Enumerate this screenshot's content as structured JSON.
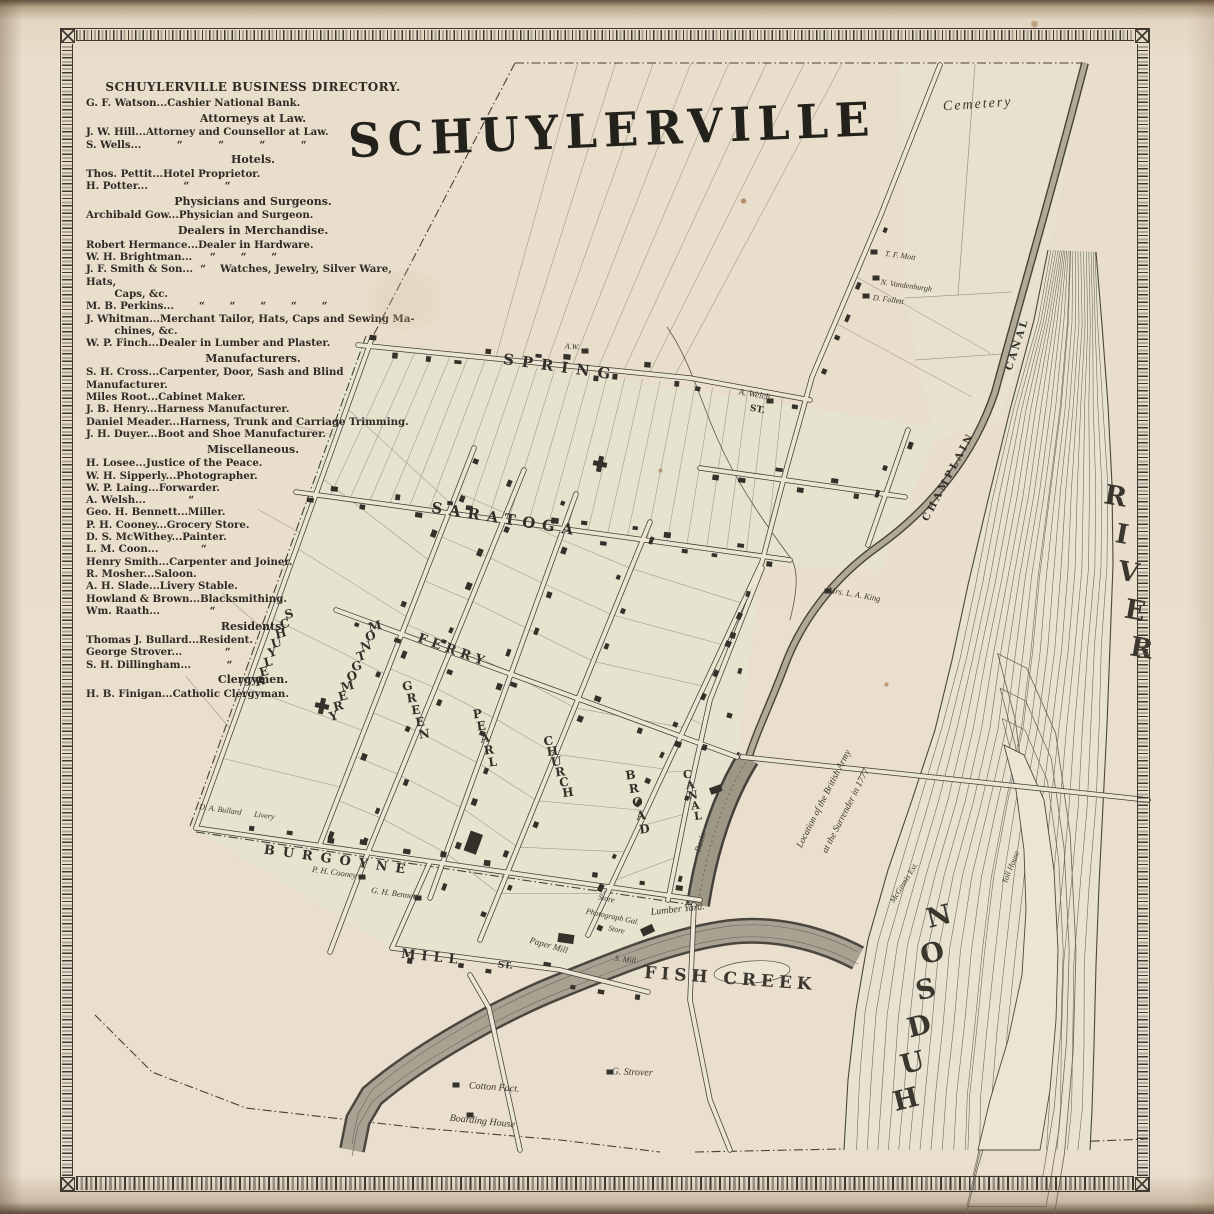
{
  "map": {
    "title": "SCHUYLERVILLE",
    "streets": {
      "spring": "SPRING",
      "saratoga": "SARATOGA",
      "ferry": "FERRY",
      "burgoyne": "BURGOYNE",
      "mill": "MILL",
      "st_abbr": "ST.",
      "schuyler": "SCHUYLER",
      "montgomery": "MONTGOMERY",
      "green": "GREEN",
      "pearl": "PEARL",
      "church": "CHURCH",
      "broad": "BROAD",
      "canal_st": "CANAL"
    },
    "water": {
      "hudson": "HUDSON",
      "river": "RIVER",
      "fish_creek": "FISH CREEK",
      "champlain": "CHAMPLAIN",
      "canal": "CANAL",
      "basin": "Basin"
    },
    "places": {
      "cemetery": "Cemetery",
      "toll_house": "Toll House",
      "mcginnis": "McGinnis Est.",
      "surrender_1": "Location of the British Army",
      "surrender_2": "at the Surrender in 1777",
      "lumber_yard": "Lumber Yard.",
      "paper_mill": "Paper Mill",
      "saw_mill": "S. Mill",
      "photograph_gallery": "Photograph Gal.",
      "store": "Store",
      "cotton_factory": "Cotton Fact.",
      "boarding_house": "Boarding House"
    },
    "owners": {
      "aw": "A.W.",
      "a_welch": "A. Welch",
      "tf_mott": "T. F. Mott",
      "n_vandenburgh": "N. Vandenburgh",
      "d_follett": "D. Follett",
      "mrs_la_king": "Mrs. L. A. King",
      "g_strover": "G. Strover",
      "ph_cooney": "P. H. Cooney",
      "gh_bennett": "G. H. Bennett",
      "da_bullard": "D. A. Bullard",
      "livery": "Livery"
    }
  },
  "directory": {
    "title": "SCHUYLERVILLE BUSINESS DIRECTORY.",
    "sections": [
      {
        "heading": null,
        "items": [
          "G. F. Watson...Cashier National Bank."
        ]
      },
      {
        "heading": "Attorneys at Law.",
        "items": [
          "J. W. Hill...Attorney and Counsellor at Law.",
          "S. Wells...          “          “          “          “"
        ]
      },
      {
        "heading": "Hotels.",
        "items": [
          "Thos. Pettit...Hotel Proprietor.",
          "H. Potter...          “          “"
        ]
      },
      {
        "heading": "Physicians and Surgeons.",
        "items": [
          "Archibald Gow...Physician and Surgeon."
        ]
      },
      {
        "heading": "Dealers in Merchandise.",
        "items": [
          "Robert Hermance...Dealer in Hardware.",
          "W. H. Brightman...     “       “       “",
          "J. F. Smith & Son...  “    Watches, Jewelry, Silver Ware, Hats,",
          "        Caps, &c.",
          "M. B. Perkins...       “       “       “       “       “",
          "J. Whitman...Merchant Tailor, Hats, Caps and Sewing Ma-",
          "        chines, &c.",
          "W. P. Finch...Dealer in Lumber and Plaster."
        ]
      },
      {
        "heading": "Manufacturers.",
        "items": [
          "S. H. Cross...Carpenter, Door, Sash and Blind Manufacturer.",
          "Miles Root...Cabinet Maker.",
          "J. B. Henry...Harness Manufacturer.",
          "Daniel Meader...Harness, Trunk and Carriage Trimming.",
          "J. H. Duyer...Boot and Shoe Manufacturer."
        ]
      },
      {
        "heading": "Miscellaneous.",
        "items": [
          "H. Losee...Justice of the Peace.",
          "W. H. Sipperly...Photographer.",
          "W. P. Laing...Forwarder.",
          "A. Welsh...            “",
          "Geo. H. Bennett...Miller.",
          "P. H. Cooney...Grocery Store.",
          "D. S. McWithey...Painter.",
          "L. M. Coon...            “",
          "Henry Smith...Carpenter and Joiner.",
          "R. Mosher...Saloon.",
          "A. H. Slade...Livery Stable.",
          "Howland & Brown...Blacksmithing.",
          "Wm. Raath...              “"
        ]
      },
      {
        "heading": "Residents.",
        "items": [
          "Thomas J. Bullard...Resident.",
          "George Strover...            “",
          "S. H. Dillingham...          “"
        ]
      },
      {
        "heading": "Clergymen.",
        "items": [
          "H. B. Finigan...Catholic Clergyman."
        ]
      }
    ]
  }
}
